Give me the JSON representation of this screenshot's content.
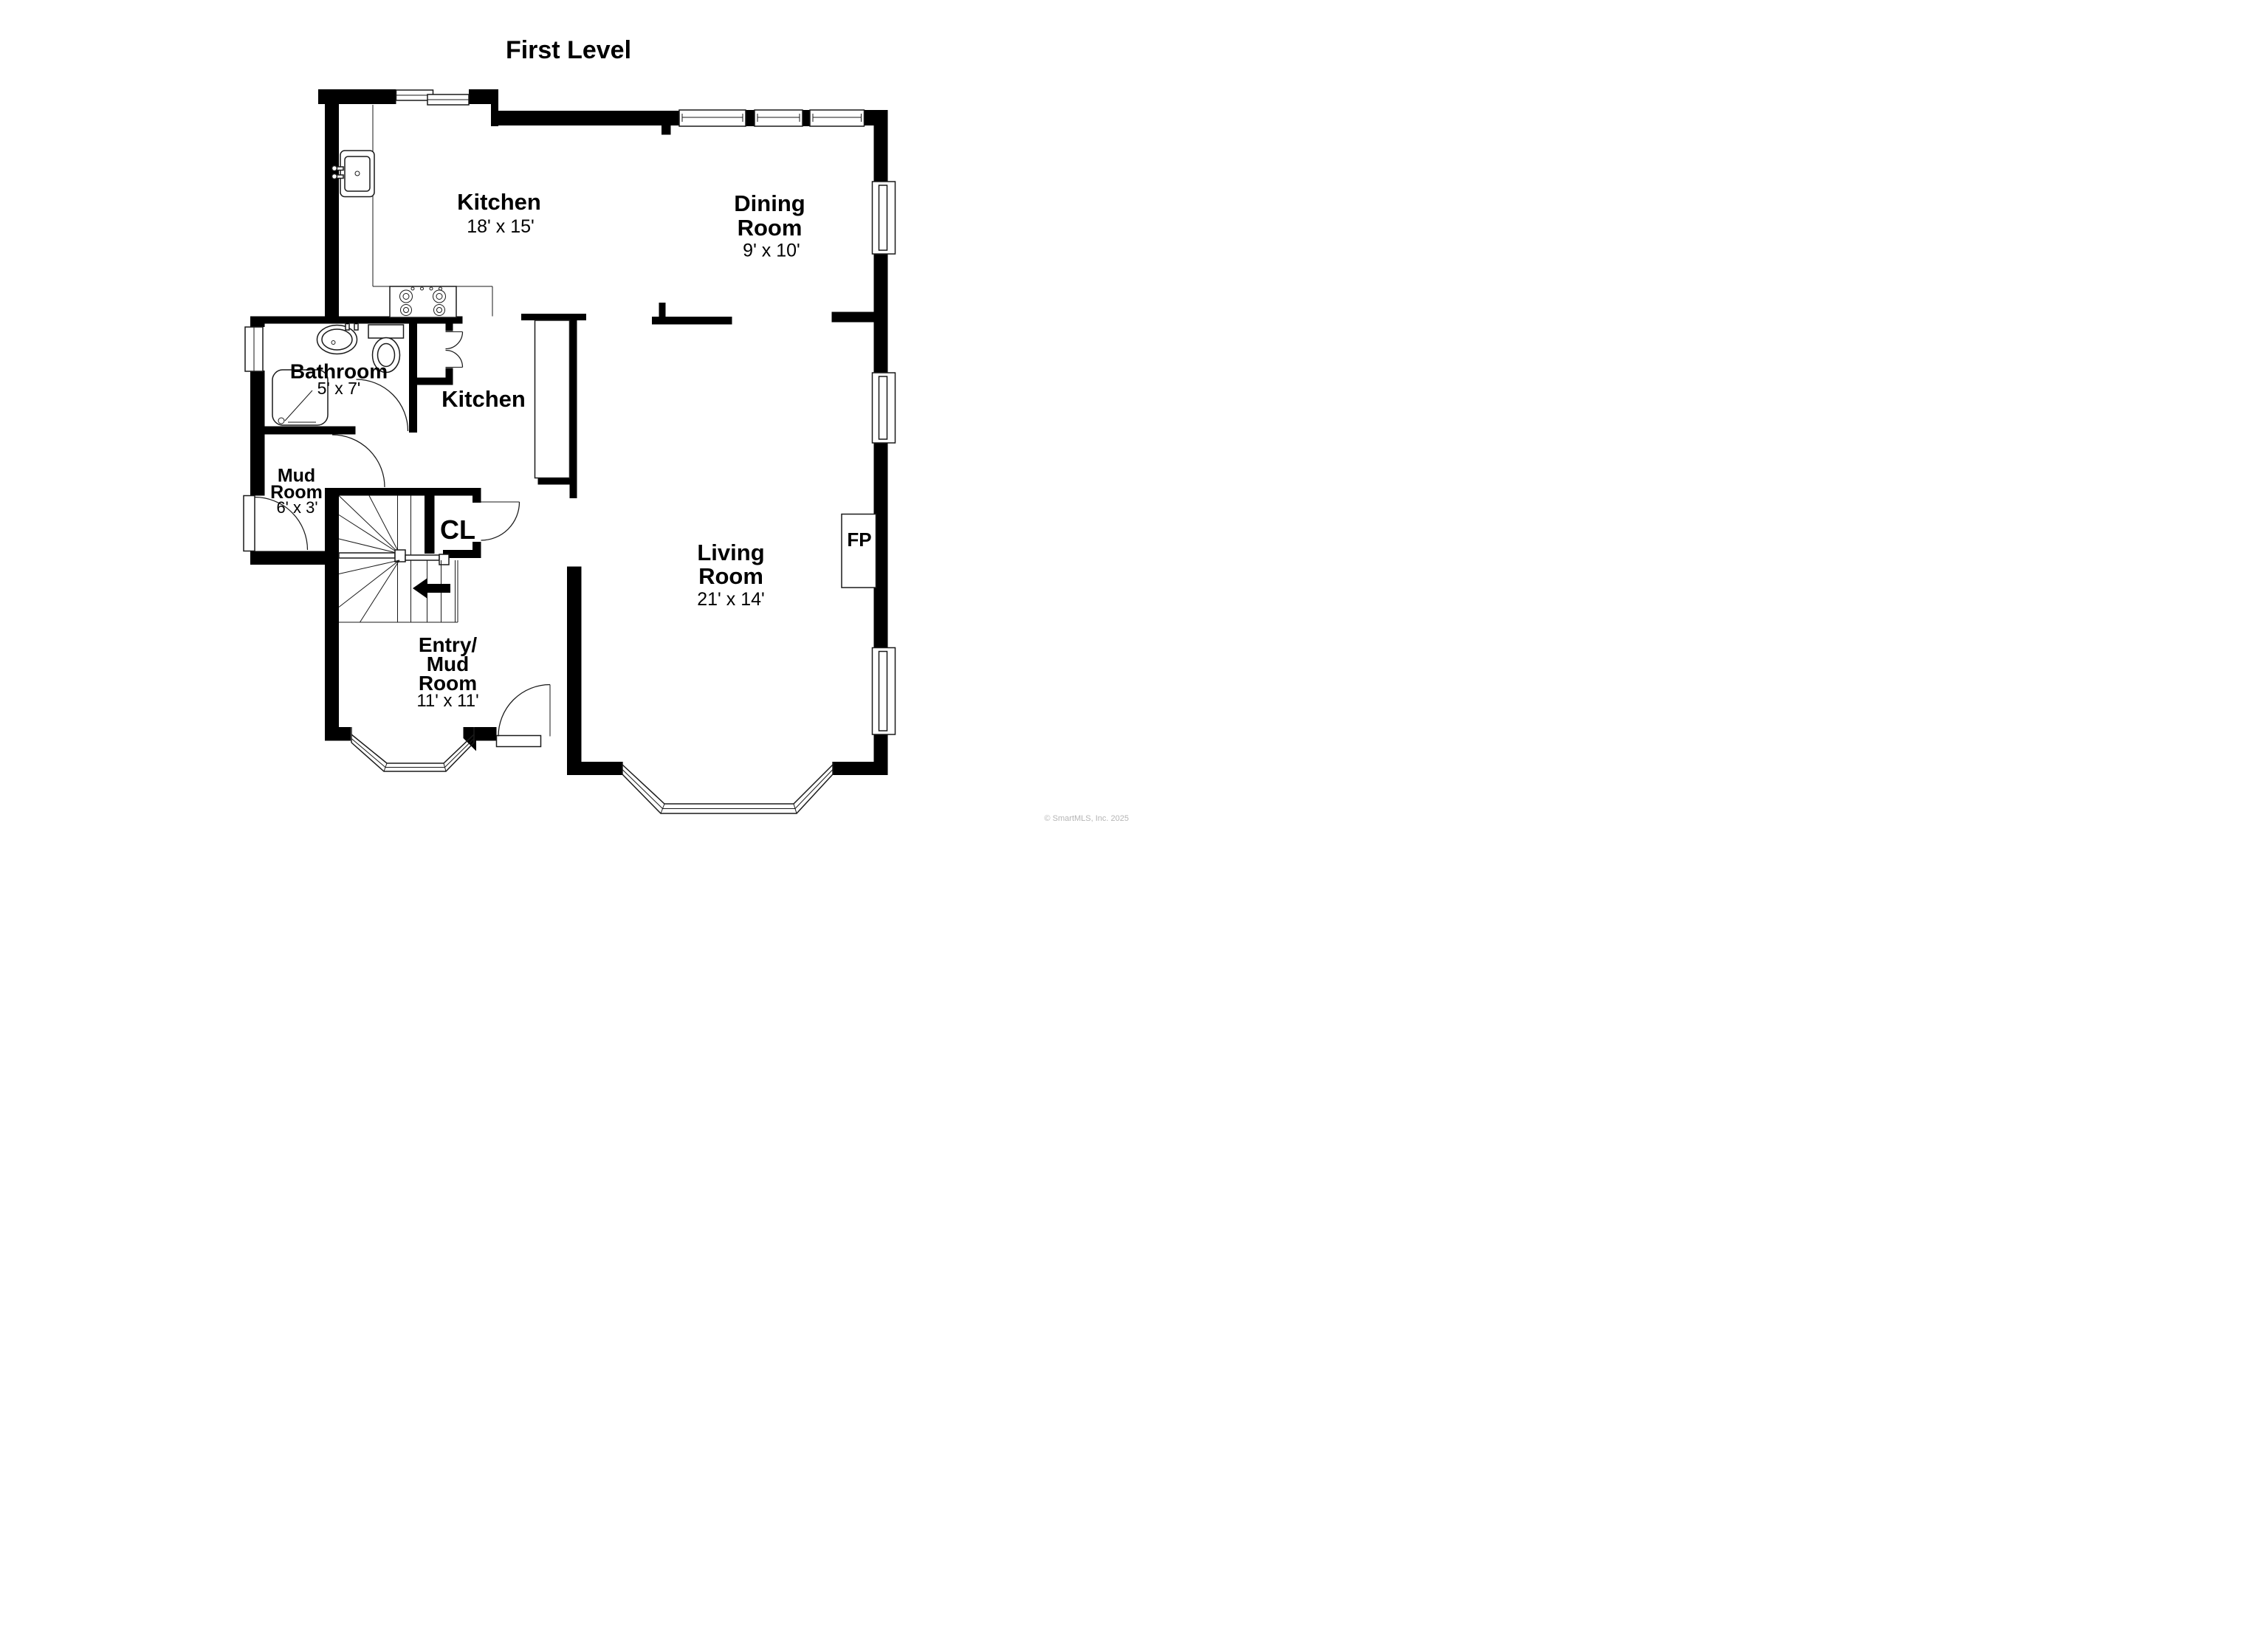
{
  "title": "First Level",
  "rooms": {
    "kitchen": {
      "name": "Kitchen",
      "dims": "18' x 15'"
    },
    "dining": {
      "name_line1": "Dining",
      "name_line2": "Room",
      "dims": "9' x 10'"
    },
    "kitchen_hall": {
      "name": "Kitchen"
    },
    "bathroom": {
      "name": "Bathroom",
      "dims": "5' x 7'"
    },
    "mud_room": {
      "name_line1": "Mud",
      "name_line2": "Room",
      "dims": "6' x 3'"
    },
    "closet": {
      "abbr": "CL"
    },
    "living": {
      "name_line1": "Living",
      "name_line2": "Room",
      "dims": "21' x 14'"
    },
    "entry": {
      "name_line1": "Entry/",
      "name_line2": "Mud",
      "name_line3": "Room",
      "dims": "11' x 11'"
    },
    "fireplace": {
      "abbr": "FP"
    }
  },
  "footer": {
    "copyright": "© SmartMLS, Inc. 2025"
  },
  "colors": {
    "wall": "#000000",
    "line": "#1a1a1a",
    "background": "#ffffff",
    "copyright": "#b5b5b5"
  }
}
